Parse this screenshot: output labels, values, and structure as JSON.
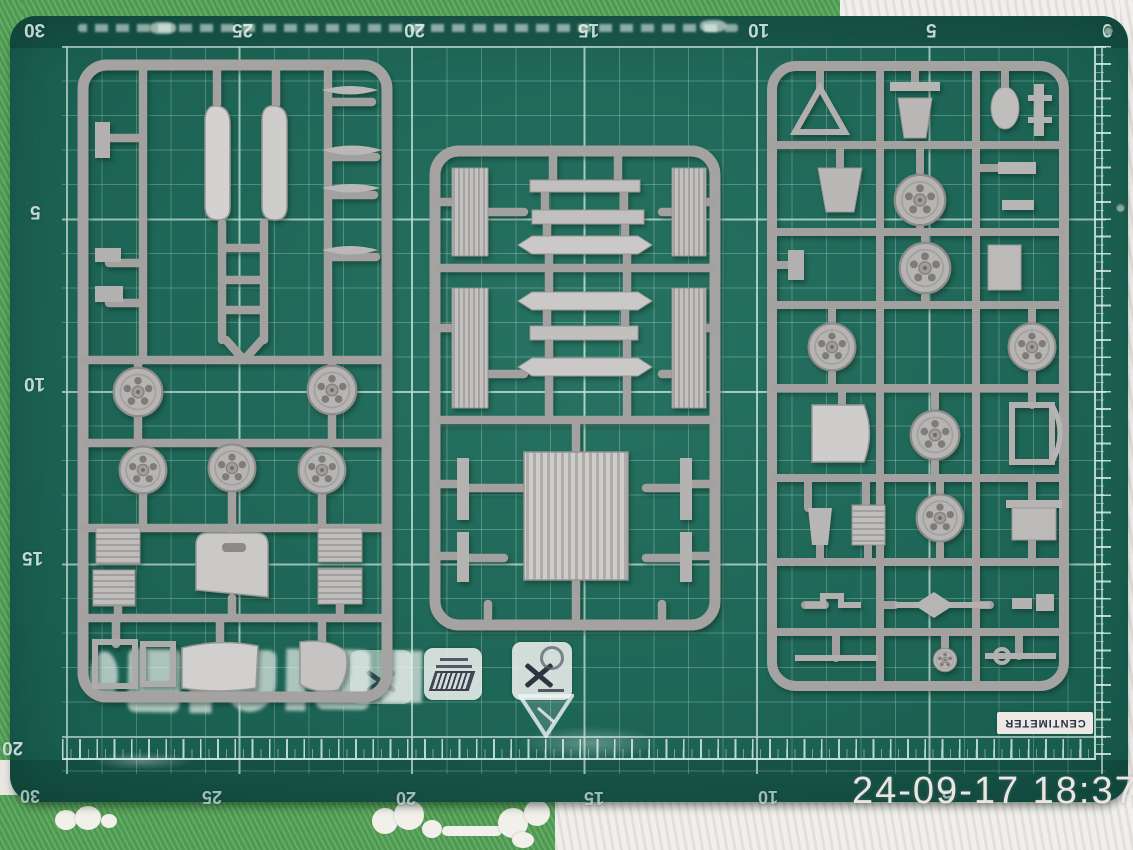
{
  "photo": {
    "timestamp": "24-09-17 18:37",
    "description": "gray model-kit sprues on a green cutting mat"
  },
  "mat": {
    "centimeter_label": "CENTIMETER",
    "rulers": {
      "top": [
        "30",
        "25",
        "20",
        "15",
        "10",
        "5",
        "0"
      ],
      "left": [
        "5",
        "10",
        "15",
        "20"
      ],
      "bottom": [
        "30",
        "25",
        "20",
        "15",
        "10",
        "5"
      ]
    }
  },
  "colors": {
    "mat_green": "#1a6a59",
    "grid_line": "#aad4c6",
    "grid_line_major": "#d8f1e8",
    "sprue_gray": "#a5a3a1",
    "part_gray": "#b7b5b3",
    "fabric_green": "#55a156",
    "fabric_white": "#eae8e3",
    "timestamp_gray": "#e9e7e3"
  }
}
